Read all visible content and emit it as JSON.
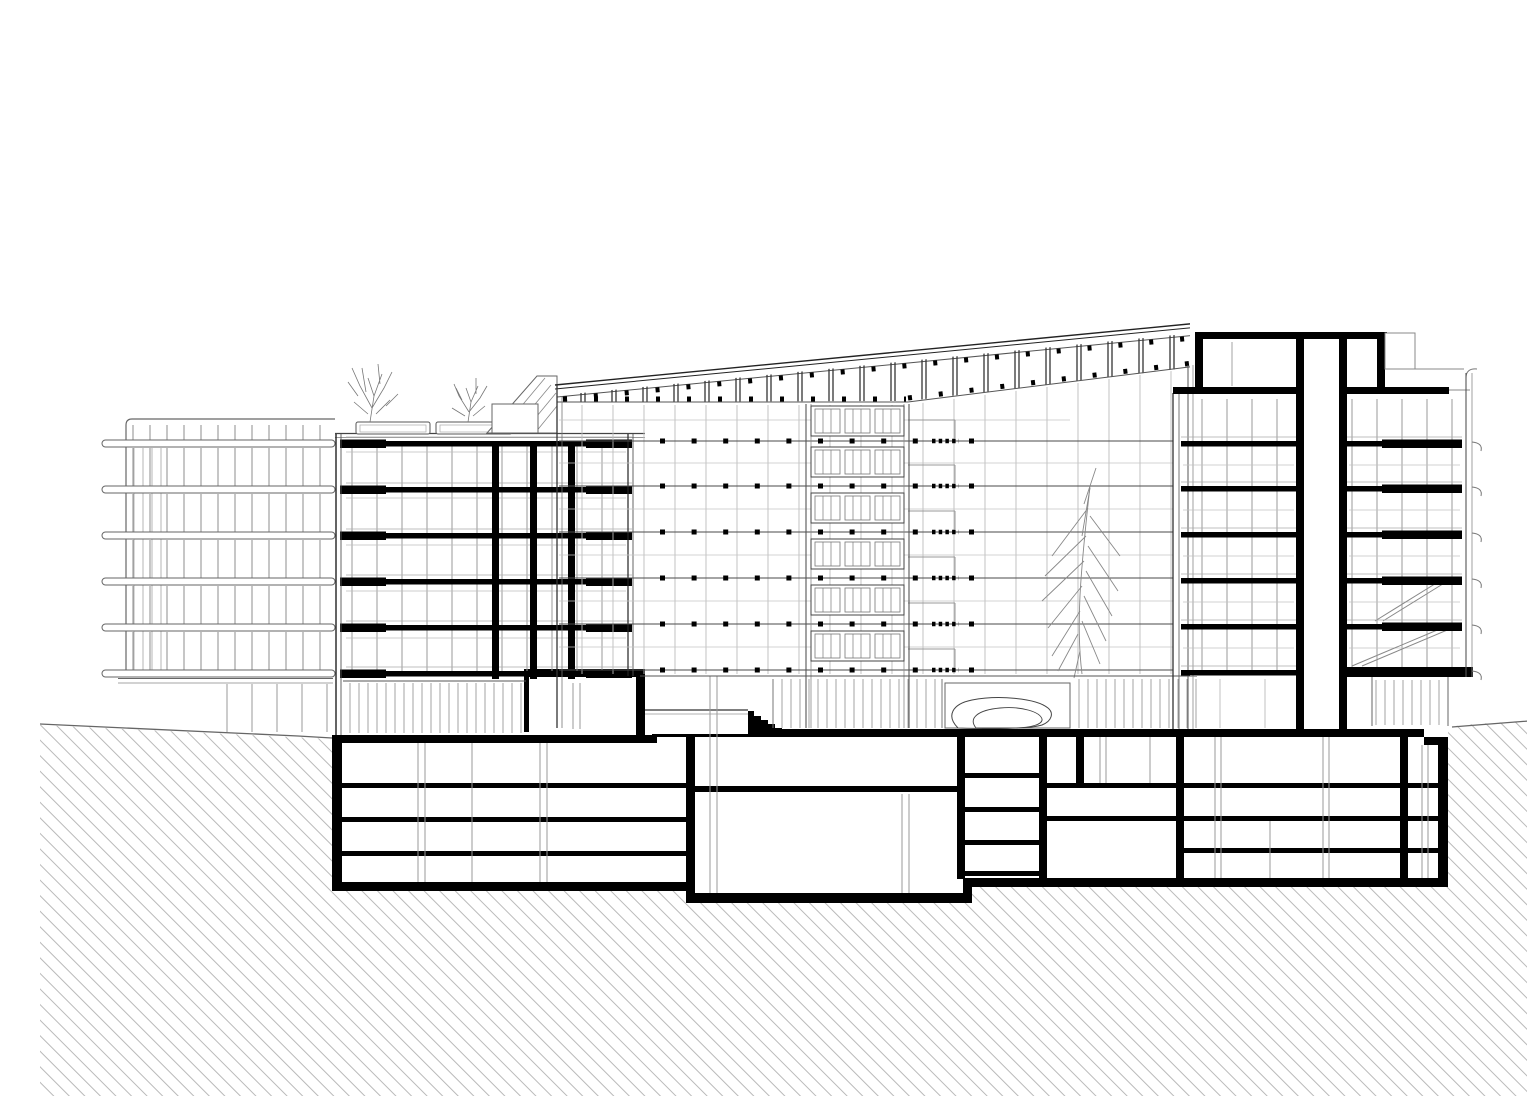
{
  "canvas": {
    "width": 1527,
    "height": 1080,
    "background": "#ffffff"
  },
  "drawing": {
    "type": "architectural-section",
    "description": "Black-and-white longitudinal section through a multi-storey building: mono-pitch roof rising to the right over a gridded atrium curtain wall, six above-ground floor slabs cut in section (solid black poché), roof terrace with two planters and shrubs on the left block, an indoor tree and an organic sculpture at atrium ground level, a vertical service core with rooftop penthouse on the right, stepped entry vestibules and stair at grade, four basement parking levels, and 45-degree earth hatching on both flanks.",
    "medium": "CAD line drawing, white background",
    "ink_color": "#000000",
    "section_line_color": "#333333",
    "elevation_line_color": "#888888",
    "fine_grid_color": "#bcbcbc",
    "earth_hatch": {
      "pattern": "45-degree diagonal lines",
      "spacing_px": 11,
      "color": "#a8a8a8"
    },
    "counts": {
      "above_ground_floor_slabs": 6,
      "basement_levels": 4,
      "roof_terrace_planters": 2,
      "roof_terrace_shrubs": 2,
      "indoor_trees": 1,
      "core_walls": 2,
      "entry_vestibules": 2
    },
    "features": [
      "earth-hatch-left",
      "earth-hatch-right",
      "ground-line",
      "background-building-elevation",
      "balcony-bands",
      "left-section-block",
      "floor-slabs",
      "columns",
      "roof-terrace",
      "planters",
      "shrubs",
      "skylight-wedge",
      "sloped-roof",
      "clerestory-columns",
      "curtain-wall-grid",
      "central-window-bay",
      "indoor-tree",
      "sculpture-blob",
      "entry-vestibule-upper",
      "entry-vestibule-lower",
      "entry-stair",
      "right-tower",
      "elevator-core",
      "rooftop-penthouse",
      "escalator-diagonals",
      "parapet-horns",
      "basement-box",
      "basement-slabs",
      "stair-core-landings"
    ]
  }
}
